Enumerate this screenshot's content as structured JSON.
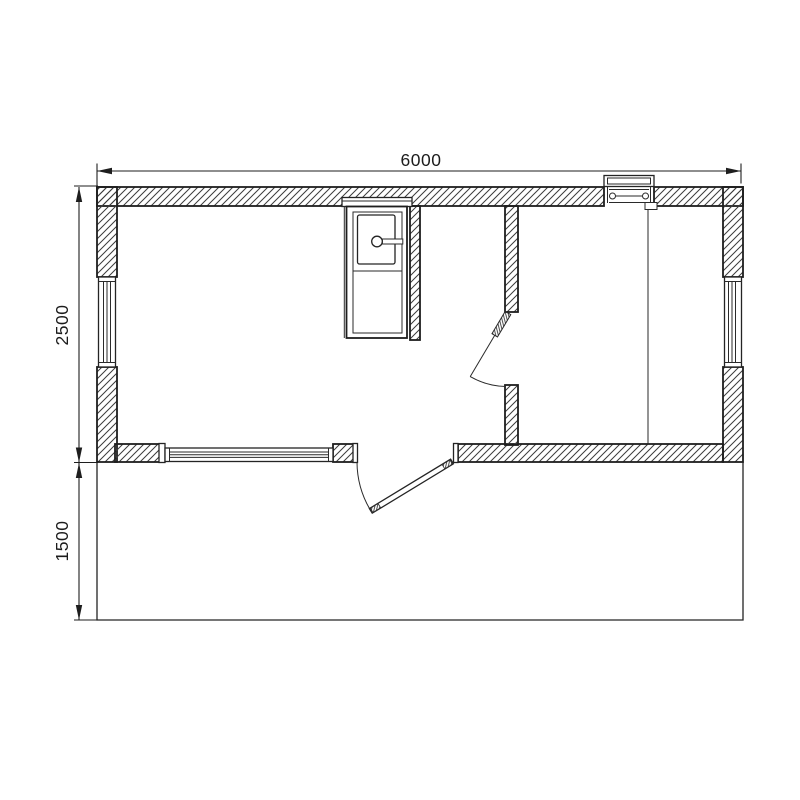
{
  "drawing": {
    "kind": "floor-plan",
    "dimensions": {
      "overall_width": "6000",
      "main_depth": "2500",
      "porch_depth": "1500"
    },
    "colors": {
      "background": "#ffffff",
      "line": "#1e1e1e",
      "hatch": "#3c3c3c"
    },
    "elements": [
      "exterior-walls",
      "interior-wall",
      "thin-partition",
      "left-window",
      "right-window",
      "bottom-window",
      "top-vent-window",
      "entrance-door",
      "interior-door",
      "stove",
      "porch-outline",
      "dimension-width",
      "dimension-main-depth",
      "dimension-porch-depth"
    ]
  }
}
